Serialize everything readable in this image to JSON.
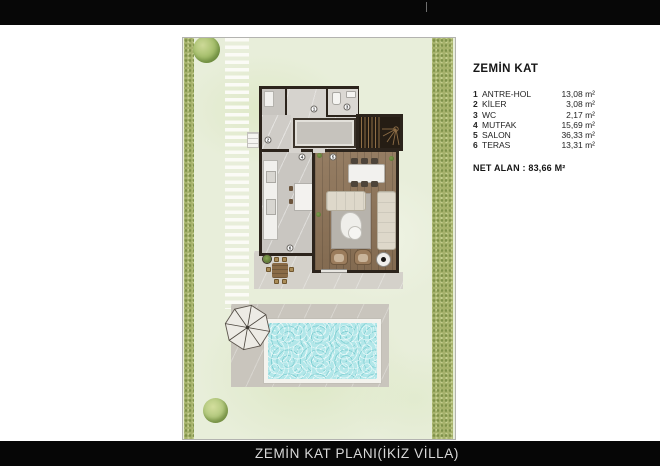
{
  "footer": {
    "title": "ZEMİN KAT PLANI(İKİZ VİLLA)"
  },
  "legend": {
    "title": "ZEMİN KAT",
    "rows": [
      {
        "n": "1",
        "name": "ANTRE-HOL",
        "area": "13,08 m²"
      },
      {
        "n": "2",
        "name": "KİLER",
        "area": "3,08 m²"
      },
      {
        "n": "3",
        "name": "WC",
        "area": "2,17 m²"
      },
      {
        "n": "4",
        "name": "MUTFAK",
        "area": "15,69 m²"
      },
      {
        "n": "5",
        "name": "SALON",
        "area": "36,33 m²"
      },
      {
        "n": "6",
        "name": "TERAS",
        "area": "13,31 m²"
      }
    ],
    "net_area": "NET ALAN : 83,66 M²"
  },
  "plan": {
    "markers": [
      "1",
      "2",
      "3",
      "4",
      "5",
      "6"
    ]
  },
  "colors": {
    "bar_black": "#070707",
    "grass": "#e8eeda",
    "hedge_green": "#a6b26c",
    "pool_water": "#b2e7e9",
    "wall_dark": "#2c241c",
    "wood_floor": "#8d7357",
    "deck_gray": "#c9c5bd"
  }
}
